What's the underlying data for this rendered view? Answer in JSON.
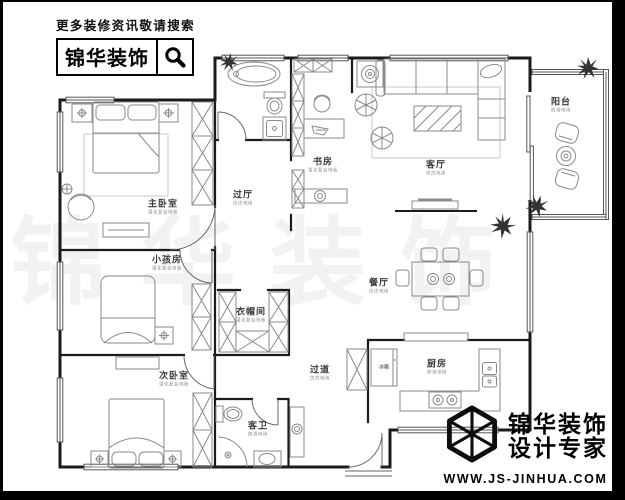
{
  "header": {
    "slogan": "更多装修资讯敬请搜索",
    "brand": "锦华装饰",
    "search_icon": "magnifier"
  },
  "footer": {
    "brand_line1": "锦华装饰",
    "brand_line2": "设计专家",
    "website": "WWW.JS-JINHUA.COM",
    "logo_icon": "isometric-cube"
  },
  "watermark": {
    "text": "锦华装饰"
  },
  "floorplan": {
    "colors": {
      "wall": "#1b1b1b",
      "furniture": "#8a8a8a",
      "plant": "#333333",
      "window": "#555555"
    },
    "rooms": [
      {
        "id": "master-bedroom",
        "label": "主卧室",
        "sub": "强化复合地板",
        "x": 163,
        "y": 206
      },
      {
        "id": "kids-room",
        "label": "小孩房",
        "sub": "强化复合地板",
        "x": 167,
        "y": 262
      },
      {
        "id": "second-bedroom",
        "label": "次卧室",
        "sub": "强化复合地板",
        "x": 174,
        "y": 378
      },
      {
        "id": "study",
        "label": "书房",
        "sub": "强化复合地板",
        "x": 323,
        "y": 164
      },
      {
        "id": "living-room",
        "label": "客厅",
        "sub": "仿古地砖",
        "x": 436,
        "y": 167
      },
      {
        "id": "dining-room",
        "label": "餐厅",
        "sub": "仿古地砖",
        "x": 379,
        "y": 285
      },
      {
        "id": "hall",
        "label": "过厅",
        "sub": "仿古地砖",
        "x": 243,
        "y": 197
      },
      {
        "id": "corridor",
        "label": "过道",
        "sub": "仿古地砖",
        "x": 320,
        "y": 372
      },
      {
        "id": "cloakroom",
        "label": "衣帽间",
        "sub": "强化复合地板",
        "x": 251,
        "y": 314
      },
      {
        "id": "kitchen",
        "label": "厨房",
        "sub": "防滑地砖",
        "x": 437,
        "y": 366
      },
      {
        "id": "guest-bathroom",
        "label": "客卫",
        "sub": "防滑地砖",
        "x": 258,
        "y": 428
      },
      {
        "id": "balcony",
        "label": "阳台",
        "sub": "防滑地砖",
        "x": 561,
        "y": 104
      },
      {
        "id": "fridge",
        "label": "冰箱",
        "sub": "",
        "x": 384,
        "y": 367,
        "size": "tiny"
      }
    ]
  }
}
